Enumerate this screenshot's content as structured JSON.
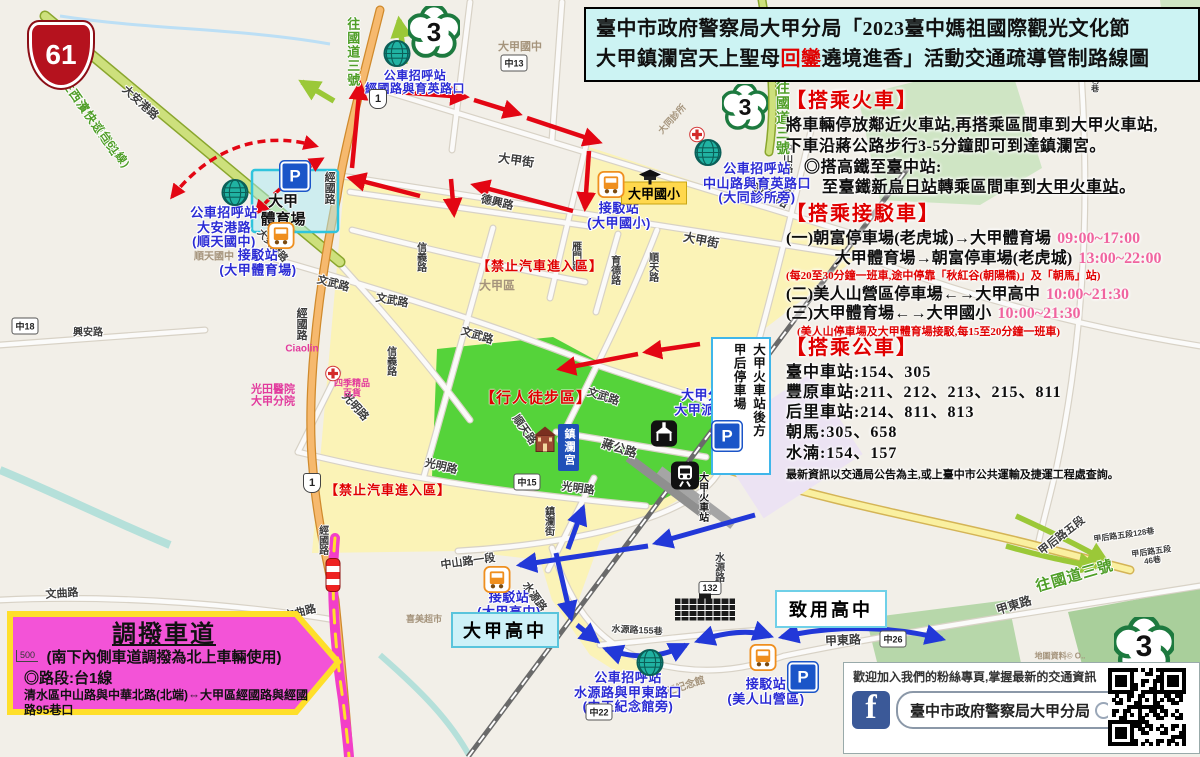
{
  "title": {
    "line1": "臺中市政府警察局大甲分局「2023臺中媽祖國際觀光文化節",
    "line2_pre": "大甲鎮瀾宮天上聖母",
    "line2_red": "回鑾",
    "line2_post": "遶境進香」活動交通疏導管制路線圖"
  },
  "info": {
    "train": {
      "header": "【搭乘火車】",
      "l1": "將車輛停放鄰近火車站,再搭乘區間車到大甲火車站,",
      "l2": "下車沿蔣公路步行3-5分鐘即可到達鎮瀾宮。",
      "l3": "◎搭高鐵至臺中站:",
      "l4_pre": "至臺鐵",
      "l4_u1": "新烏日站",
      "l4_mid": "轉乘區間車到",
      "l4_u2": "大甲火車站",
      "l4_post": "。"
    },
    "shuttle": {
      "header": "【搭乘接駁車】",
      "rows": [
        {
          "label": "(一)朝富停車場(老虎城)→大甲體育場",
          "time": "09:00~17:00"
        },
        {
          "label": "　　　大甲體育場→朝富停車場(老虎城)",
          "time": "13:00~22:00"
        },
        {
          "note": "(每20至30分鐘一班車,途中停靠「秋紅谷(朝陽橋)」及「朝馬」站)"
        },
        {
          "label": "(二)美人山營區停車場←→大甲高中",
          "time": "10:00~21:30"
        },
        {
          "label": "(三)大甲體育場←→大甲國小",
          "time": "10:00~21:30"
        },
        {
          "note": "　(美人山停車場及大甲體育場接駁,每15至20分鐘一班車)"
        }
      ]
    },
    "bus": {
      "header": "【搭乘公車】",
      "lines": [
        {
          "station": "臺中車站",
          "routes": "154、305"
        },
        {
          "station": "豐原車站",
          "routes": "211、212、213、215、811"
        },
        {
          "station": "后里車站",
          "routes": "214、811、813"
        },
        {
          "station": "朝馬",
          "routes": "305、658"
        },
        {
          "station": "水湳",
          "routes": "154、157"
        }
      ],
      "note": "最新資訊以交通局公告為主,或上臺中市公共運輸及捷運工程處查詢。"
    }
  },
  "lane": {
    "title": "調撥車道",
    "line1": "(南下內側車道調撥為北上車輛使用)",
    "line2": "◎路段:台1線",
    "line3": "清水區中山路與中華北路(北端)⇔大甲區經國路與經國路95巷口",
    "scale": "500"
  },
  "fanpage": {
    "message": "歡迎加入我們的粉絲專頁,掌握最新的交通資訊",
    "fb_letter": "f",
    "search": "臺中市政府警察局大甲分局"
  },
  "boxes": {
    "stadium": "大甲\n體育場",
    "elementary": "大甲國小",
    "highschool": "大甲高中",
    "zhiyong": "致用高中",
    "parking_col1": "大甲火車站後方",
    "parking_col2": "甲后停車場",
    "temple": "鎮瀾宮"
  },
  "colors": {
    "title_bg": "#ccf3f3",
    "header_red": "#e00000",
    "time_pink": "#f0649f",
    "zone_yellow": "#fbf2b5",
    "zone_green": "#47d02f",
    "lane_magenta": "#f353d7",
    "lane_border": "#ffdf2a",
    "blue_label": "#2b2bd4",
    "route_red": "#e30613",
    "route_blue": "#2238d8",
    "hwy61_red": "#b5121e",
    "fb_blue": "#3b5998"
  },
  "map": {
    "labels": [
      {
        "t": "文武路",
        "x": 333,
        "y": 284,
        "c": "road",
        "r": 15
      },
      {
        "t": "文武路",
        "x": 392,
        "y": 301,
        "c": "road",
        "r": 10
      },
      {
        "t": "文武路",
        "x": 477,
        "y": 336,
        "c": "road",
        "r": 17
      },
      {
        "t": "文武路",
        "x": 603,
        "y": 397,
        "c": "road",
        "r": 18
      },
      {
        "t": "育英路",
        "x": 770,
        "y": 196,
        "c": "road",
        "r": 26,
        "fs": 13
      },
      {
        "t": "大甲街",
        "x": 516,
        "y": 161,
        "c": "road",
        "r": 8,
        "fs": 12
      },
      {
        "t": "大甲街",
        "x": 701,
        "y": 241,
        "c": "road",
        "r": 11,
        "fs": 12
      },
      {
        "t": "德興路",
        "x": 497,
        "y": 203,
        "c": "road",
        "r": 13
      },
      {
        "t": "雁門路",
        "x": 575,
        "y": 256,
        "c": "roadv",
        "fs": 10
      },
      {
        "t": "中山路一段",
        "x": 786,
        "y": 168,
        "c": "roadv",
        "fs": 10
      },
      {
        "t": "中山路一段",
        "x": 468,
        "y": 562,
        "c": "road",
        "r": -8,
        "fs": 11
      },
      {
        "t": "蔣公路",
        "x": 619,
        "y": 449,
        "c": "road",
        "r": 17,
        "fs": 12
      },
      {
        "t": "順天路",
        "x": 524,
        "y": 430,
        "c": "road",
        "r": 55,
        "fs": 11
      },
      {
        "t": "順天路",
        "x": 652,
        "y": 267,
        "c": "roadv",
        "fs": 10
      },
      {
        "t": "育德路",
        "x": 614,
        "y": 270,
        "c": "roadv",
        "fs": 10
      },
      {
        "t": "信義路",
        "x": 420,
        "y": 257,
        "c": "roadv",
        "fs": 10
      },
      {
        "t": "信義路",
        "x": 390,
        "y": 361,
        "c": "roadv",
        "fs": 10
      },
      {
        "t": "光明路",
        "x": 355,
        "y": 407,
        "c": "road",
        "r": 48,
        "fs": 11
      },
      {
        "t": "光明路",
        "x": 441,
        "y": 467,
        "c": "road",
        "r": 13,
        "fs": 11
      },
      {
        "t": "光明路",
        "x": 578,
        "y": 489,
        "c": "road",
        "r": 7,
        "fs": 11
      },
      {
        "t": "經國路",
        "x": 329,
        "y": 188,
        "c": "roadv",
        "fs": 11
      },
      {
        "t": "經國路",
        "x": 301,
        "y": 324,
        "c": "roadv",
        "fs": 11
      },
      {
        "t": "經國路",
        "x": 322,
        "y": 540,
        "c": "roadv",
        "fs": 10
      },
      {
        "t": "大安港路",
        "x": 140,
        "y": 103,
        "c": "road",
        "r": 42,
        "fs": 11
      },
      {
        "t": "大安港路",
        "x": 272,
        "y": 246,
        "c": "road",
        "r": 48,
        "fs": 10
      },
      {
        "t": "興安路",
        "x": 88,
        "y": 333,
        "c": "road",
        "fs": 10
      },
      {
        "t": "文曲路",
        "x": 62,
        "y": 594,
        "c": "road",
        "r": -4,
        "fs": 11
      },
      {
        "t": "文曲路",
        "x": 300,
        "y": 613,
        "c": "road",
        "r": -14,
        "fs": 11
      },
      {
        "t": "水源路",
        "x": 534,
        "y": 597,
        "c": "road",
        "r": 55,
        "fs": 11
      },
      {
        "t": "水源路",
        "x": 718,
        "y": 567,
        "c": "roadv",
        "fs": 10
      },
      {
        "t": "水源路155巷",
        "x": 637,
        "y": 630,
        "c": "road",
        "r": 3,
        "fs": 9
      },
      {
        "t": "甲東路",
        "x": 843,
        "y": 641,
        "c": "road",
        "r": -3,
        "fs": 12
      },
      {
        "t": "甲東路",
        "x": 1014,
        "y": 606,
        "c": "road",
        "r": -17,
        "fs": 12
      },
      {
        "t": "甲后路五段",
        "x": 1062,
        "y": 536,
        "c": "road",
        "r": -38,
        "fs": 11
      },
      {
        "t": "甲后路五段128巷",
        "x": 1124,
        "y": 536,
        "c": "road",
        "r": -8,
        "fs": 8
      },
      {
        "t": "甲后路五段46巷",
        "x": 1152,
        "y": 557,
        "c": "road",
        "r": -8,
        "fs": 8
      },
      {
        "t": "甲后路五段130巷",
        "x": 1094,
        "y": 62,
        "c": "roadv",
        "fs": 8
      },
      {
        "t": "鎮瀾街",
        "x": 548,
        "y": 521,
        "c": "roadv",
        "fs": 10
      },
      {
        "t": "大甲火車站",
        "x": 702,
        "y": 497,
        "c": "blackv",
        "fs": 10
      },
      {
        "t": "大甲區",
        "x": 497,
        "y": 286,
        "c": "grayl",
        "fs": 12
      },
      {
        "t": "大甲國中",
        "x": 520,
        "y": 47,
        "c": "grayl",
        "fs": 11
      },
      {
        "t": "順天國中",
        "x": 214,
        "y": 257,
        "c": "grayl",
        "fs": 10
      },
      {
        "t": "中正紀念館",
        "x": 681,
        "y": 688,
        "c": "grayl",
        "r": -18,
        "fs": 10
      },
      {
        "t": "大同診所",
        "x": 672,
        "y": 119,
        "c": "grayl",
        "r": -48,
        "fs": 9
      },
      {
        "t": "喜美超市",
        "x": 424,
        "y": 619,
        "c": "grayl",
        "fs": 9
      },
      {
        "t": "地圖資料© O..",
        "x": 1060,
        "y": 657,
        "c": "grayl",
        "fs": 8
      },
      {
        "t": "Ciaolin",
        "x": 302,
        "y": 349,
        "c": "pinkl",
        "fs": 10
      },
      {
        "t": "四季精品\n百貨",
        "x": 352,
        "y": 388,
        "c": "pinkl",
        "fs": 9
      },
      {
        "t": "光田醫院\n大甲分院",
        "x": 273,
        "y": 396,
        "c": "pinkl",
        "fs": 11
      },
      {
        "t": "公車招呼站\n經國路與育英路口",
        "x": 415,
        "y": 83,
        "c": "blue",
        "fs": 12
      },
      {
        "t": "公車招呼站\n中山路與育英路口\n(大同診所旁)",
        "x": 757,
        "y": 184,
        "c": "blue"
      },
      {
        "t": "公車招呼站\n大安港路\n(順天國中)",
        "x": 224,
        "y": 228,
        "c": "blue"
      },
      {
        "t": "接駁站\n(大甲體育場)",
        "x": 258,
        "y": 263,
        "c": "blue"
      },
      {
        "t": "接駁站\n(大甲國小)",
        "x": 619,
        "y": 216,
        "c": "blue"
      },
      {
        "t": "接駁站\n(大甲高中)",
        "x": 509,
        "y": 605,
        "c": "blue"
      },
      {
        "t": "接駁站\n(美人山營區)",
        "x": 766,
        "y": 692,
        "c": "blue"
      },
      {
        "t": "公車招呼站\n水源路與甲東路口\n(中正紀念館旁)",
        "x": 628,
        "y": 693,
        "c": "blue"
      },
      {
        "t": "大甲分局\n大甲派出所",
        "x": 708,
        "y": 403,
        "c": "blue"
      },
      {
        "t": "【行人徒步區】",
        "x": 536,
        "y": 399,
        "c": "red",
        "fs": 15
      },
      {
        "t": "【禁止汽車進入區】",
        "x": 540,
        "y": 267,
        "c": "red",
        "fs": 13
      },
      {
        "t": "【禁止汽車進入區】",
        "x": 388,
        "y": 491,
        "c": "red",
        "fs": 13
      },
      {
        "t": "往國道三號",
        "x": 352,
        "y": 52,
        "c": "greenv",
        "fs": 13
      },
      {
        "t": "往國道三號",
        "x": 782,
        "y": 118,
        "c": "greenv",
        "fs": 14
      },
      {
        "t": "往國道三號",
        "x": 1075,
        "y": 577,
        "c": "green",
        "r": -16,
        "fs": 15
      },
      {
        "t": "往西濱快速道路",
        "x": 90,
        "y": 118,
        "c": "green",
        "r": 55,
        "fs": 12
      },
      {
        "t": "(台61線)",
        "x": 113,
        "y": 148,
        "c": "green",
        "r": 55,
        "fs": 11
      }
    ],
    "shields": [
      {
        "t": "61",
        "type": "hw61",
        "x": 61,
        "y": 55
      },
      {
        "t": "1",
        "type": "prov",
        "x": 378,
        "y": 99
      },
      {
        "t": "1",
        "type": "prov",
        "x": 312,
        "y": 483
      },
      {
        "t": "3",
        "type": "plum",
        "x": 434,
        "y": 32,
        "s": 52
      },
      {
        "t": "3",
        "type": "plum",
        "x": 745,
        "y": 107,
        "s": 46
      },
      {
        "t": "3",
        "type": "plum",
        "x": 1144,
        "y": 647,
        "s": 60
      },
      {
        "t": "132",
        "type": "county",
        "x": 710,
        "y": 588
      },
      {
        "t": "中13",
        "type": "county",
        "x": 514,
        "y": 63
      },
      {
        "t": "中15",
        "type": "county",
        "x": 1023,
        "y": 33
      },
      {
        "t": "中15",
        "type": "county",
        "x": 527,
        "y": 482
      },
      {
        "t": "中18",
        "type": "county",
        "x": 25,
        "y": 326
      },
      {
        "t": "中26",
        "type": "county",
        "x": 893,
        "y": 639
      },
      {
        "t": "中22",
        "type": "county",
        "x": 599,
        "y": 712
      }
    ],
    "icons": [
      {
        "type": "parking",
        "x": 295,
        "y": 176
      },
      {
        "type": "parking",
        "x": 727,
        "y": 436
      },
      {
        "type": "parking",
        "x": 803,
        "y": 677
      },
      {
        "type": "bus",
        "x": 281,
        "y": 238
      },
      {
        "type": "bus",
        "x": 611,
        "y": 187
      },
      {
        "type": "bus",
        "x": 497,
        "y": 582
      },
      {
        "type": "bus",
        "x": 763,
        "y": 660
      },
      {
        "type": "globe",
        "x": 397,
        "y": 56
      },
      {
        "type": "globe",
        "x": 708,
        "y": 155
      },
      {
        "type": "globe",
        "x": 235,
        "y": 195
      },
      {
        "type": "globe",
        "x": 650,
        "y": 665
      },
      {
        "type": "cross",
        "x": 697,
        "y": 137
      },
      {
        "type": "cross",
        "x": 333,
        "y": 376
      },
      {
        "type": "temple",
        "x": 664,
        "y": 436
      },
      {
        "type": "shrine",
        "x": 545,
        "y": 441
      },
      {
        "type": "station",
        "x": 685,
        "y": 478
      },
      {
        "type": "cap",
        "x": 650,
        "y": 180
      },
      {
        "type": "building",
        "x": 705,
        "y": 610
      },
      {
        "type": "cone",
        "x": 333,
        "y": 575
      }
    ]
  }
}
